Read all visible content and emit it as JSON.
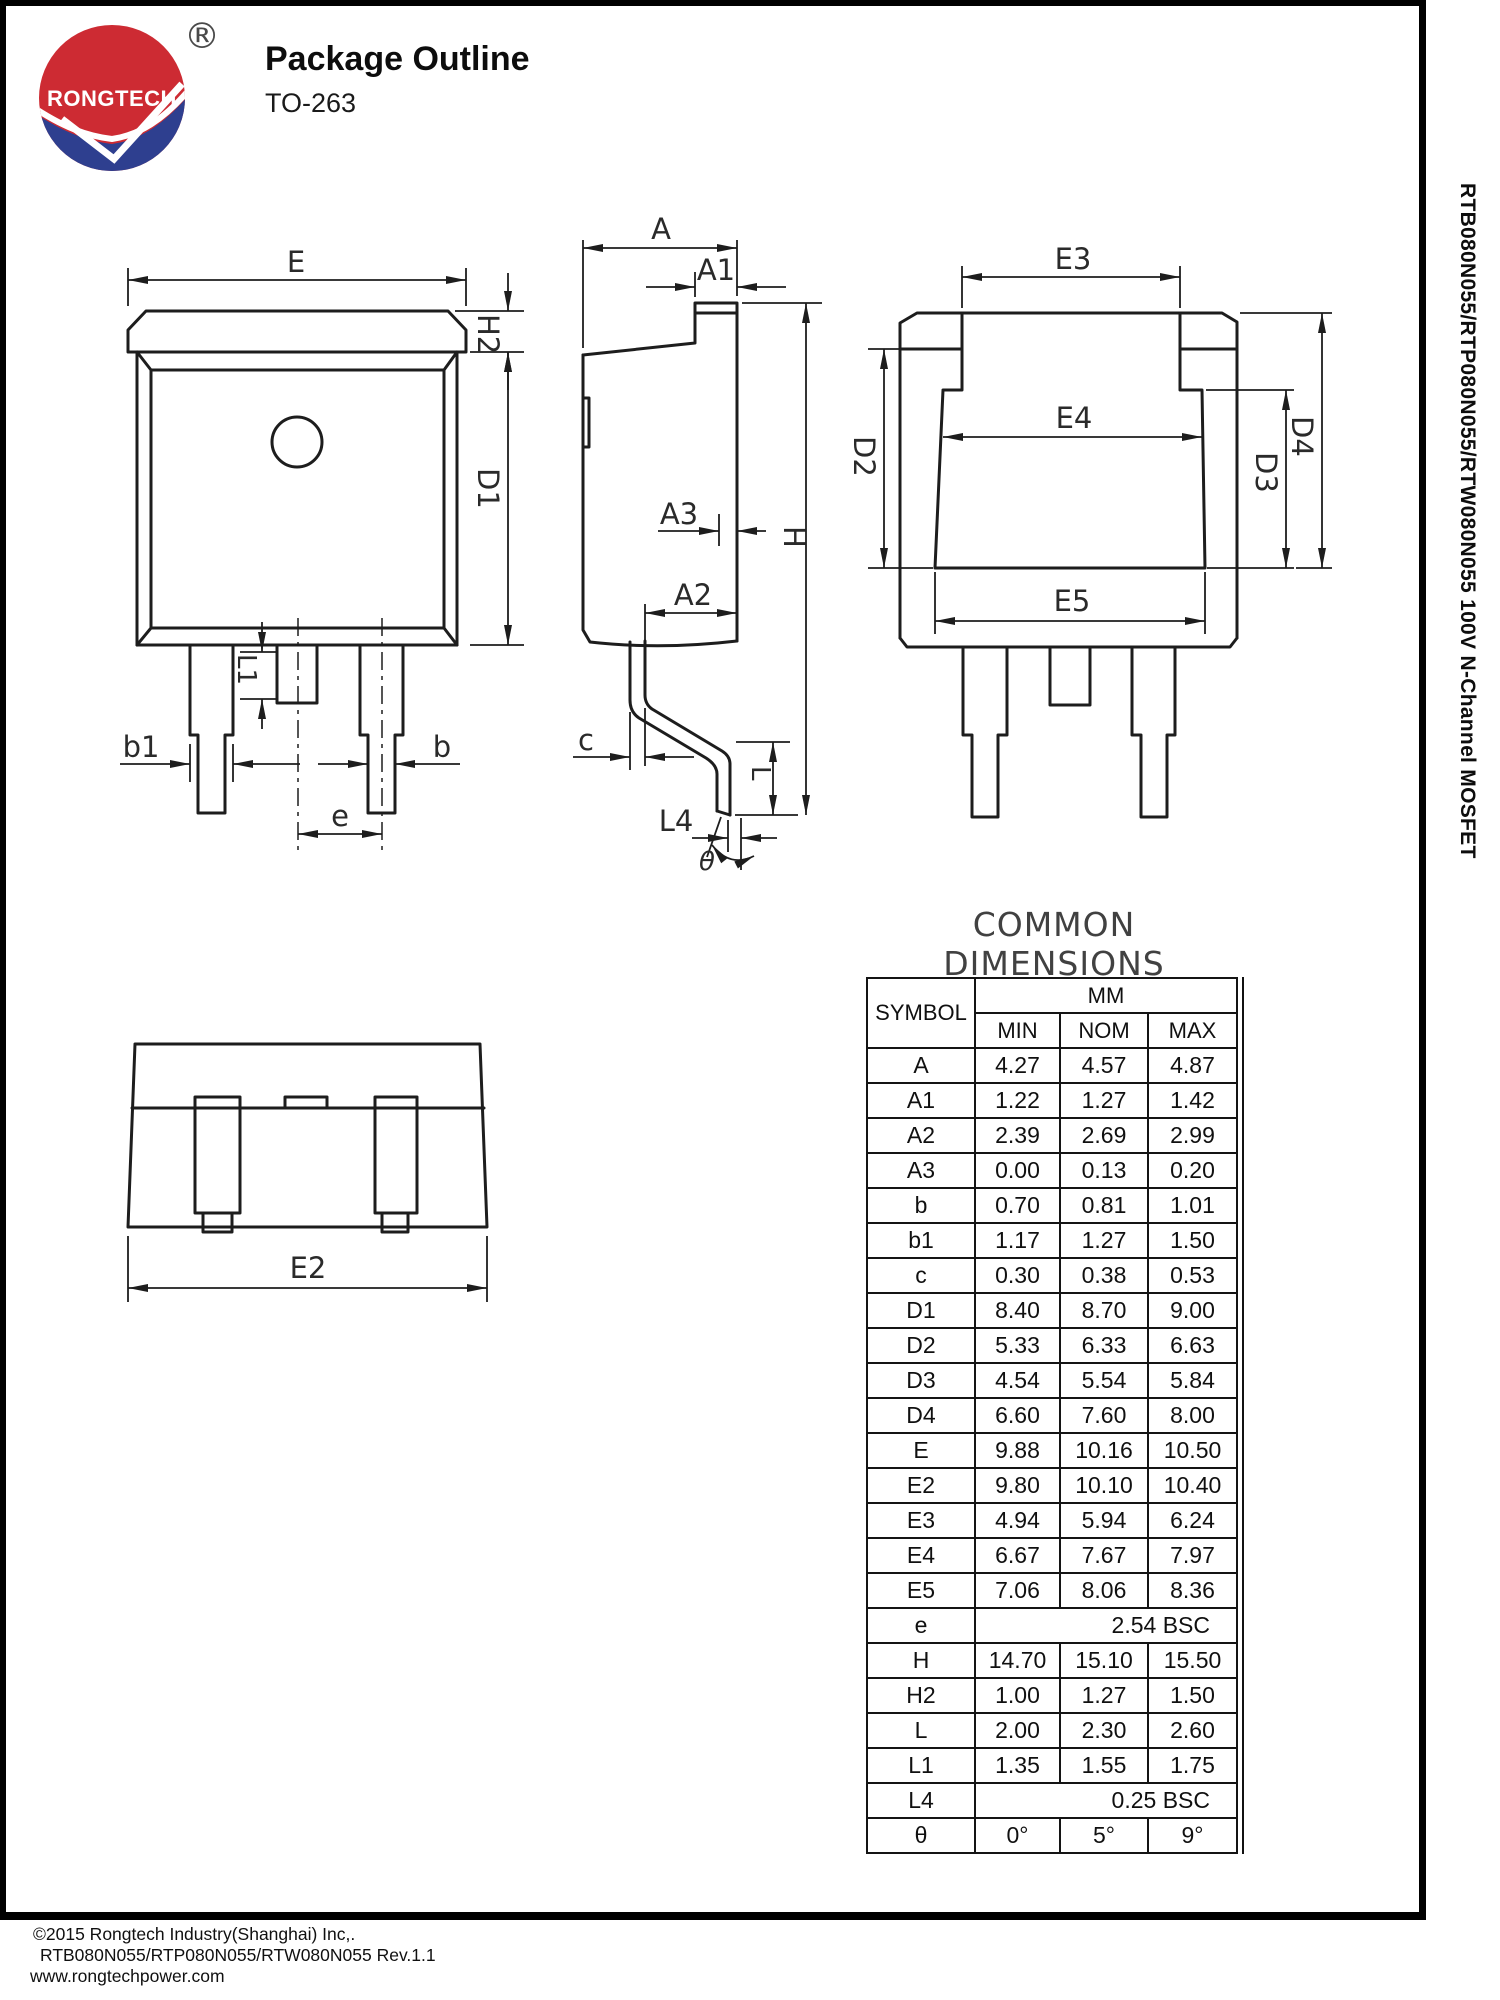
{
  "header": {
    "logo_text": "RONGTECH",
    "registered_mark": "®",
    "title": "Package Outline",
    "subtitle": "TO-263"
  },
  "sidebar": {
    "vertical_text": "RTB080N055/RTP080N055/RTW080N055 100V N-Channel MOSFET"
  },
  "drawing": {
    "labels": {
      "E": "E",
      "H2": "H2",
      "D1": "D1",
      "L1": "L1",
      "b1": "b1",
      "b": "b",
      "e": "e",
      "A": "A",
      "A1": "A1",
      "A2": "A2",
      "A3": "A3",
      "H": "H",
      "c": "c",
      "L": "L",
      "L4": "L4",
      "theta": "θ",
      "E3": "E3",
      "E4": "E4",
      "E5": "E5",
      "D2": "D2",
      "D3": "D3",
      "D4": "D4",
      "E2": "E2"
    }
  },
  "table": {
    "title": "COMMON DIMENSIONS",
    "symbol_header": "SYMBOL",
    "unit_header": "MM",
    "sub_headers": [
      "MIN",
      "NOM",
      "MAX"
    ],
    "rows": [
      {
        "symbol": "A",
        "min": "4.27",
        "nom": "4.57",
        "max": "4.87"
      },
      {
        "symbol": "A1",
        "min": "1.22",
        "nom": "1.27",
        "max": "1.42"
      },
      {
        "symbol": "A2",
        "min": "2.39",
        "nom": "2.69",
        "max": "2.99"
      },
      {
        "symbol": "A3",
        "min": "0.00",
        "nom": "0.13",
        "max": "0.20"
      },
      {
        "symbol": "b",
        "min": "0.70",
        "nom": "0.81",
        "max": "1.01"
      },
      {
        "symbol": "b1",
        "min": "1.17",
        "nom": "1.27",
        "max": "1.50"
      },
      {
        "symbol": "c",
        "min": "0.30",
        "nom": "0.38",
        "max": "0.53"
      },
      {
        "symbol": "D1",
        "min": "8.40",
        "nom": "8.70",
        "max": "9.00"
      },
      {
        "symbol": "D2",
        "min": "5.33",
        "nom": "6.33",
        "max": "6.63"
      },
      {
        "symbol": "D3",
        "min": "4.54",
        "nom": "5.54",
        "max": "5.84"
      },
      {
        "symbol": "D4",
        "min": "6.60",
        "nom": "7.60",
        "max": "8.00"
      },
      {
        "symbol": "E",
        "min": "9.88",
        "nom": "10.16",
        "max": "10.50"
      },
      {
        "symbol": "E2",
        "min": "9.80",
        "nom": "10.10",
        "max": "10.40"
      },
      {
        "symbol": "E3",
        "min": "4.94",
        "nom": "5.94",
        "max": "6.24"
      },
      {
        "symbol": "E4",
        "min": "6.67",
        "nom": "7.67",
        "max": "7.97"
      },
      {
        "symbol": "E5",
        "min": "7.06",
        "nom": "8.06",
        "max": "8.36"
      },
      {
        "symbol": "e",
        "merged": "2.54  BSC"
      },
      {
        "symbol": "H",
        "min": "14.70",
        "nom": "15.10",
        "max": "15.50"
      },
      {
        "symbol": "H2",
        "min": "1.00",
        "nom": "1.27",
        "max": "1.50"
      },
      {
        "symbol": "L",
        "min": "2.00",
        "nom": "2.30",
        "max": "2.60"
      },
      {
        "symbol": "L1",
        "min": "1.35",
        "nom": "1.55",
        "max": "1.75"
      },
      {
        "symbol": "L4",
        "merged": "0.25  BSC"
      },
      {
        "symbol": "θ",
        "min": "0°",
        "nom": "5°",
        "max": "9°"
      }
    ]
  },
  "footer": {
    "line1": "©2015 Rongtech Industry(Shanghai)  Inc,.",
    "line2": "RTB080N055/RTP080N055/RTW080N055  Rev.1.1",
    "line3": "www.rongtechpower.com"
  },
  "colors": {
    "logo_red": "#cd2b33",
    "logo_blue": "#2e3f8f",
    "line": "#1d1d1d"
  }
}
